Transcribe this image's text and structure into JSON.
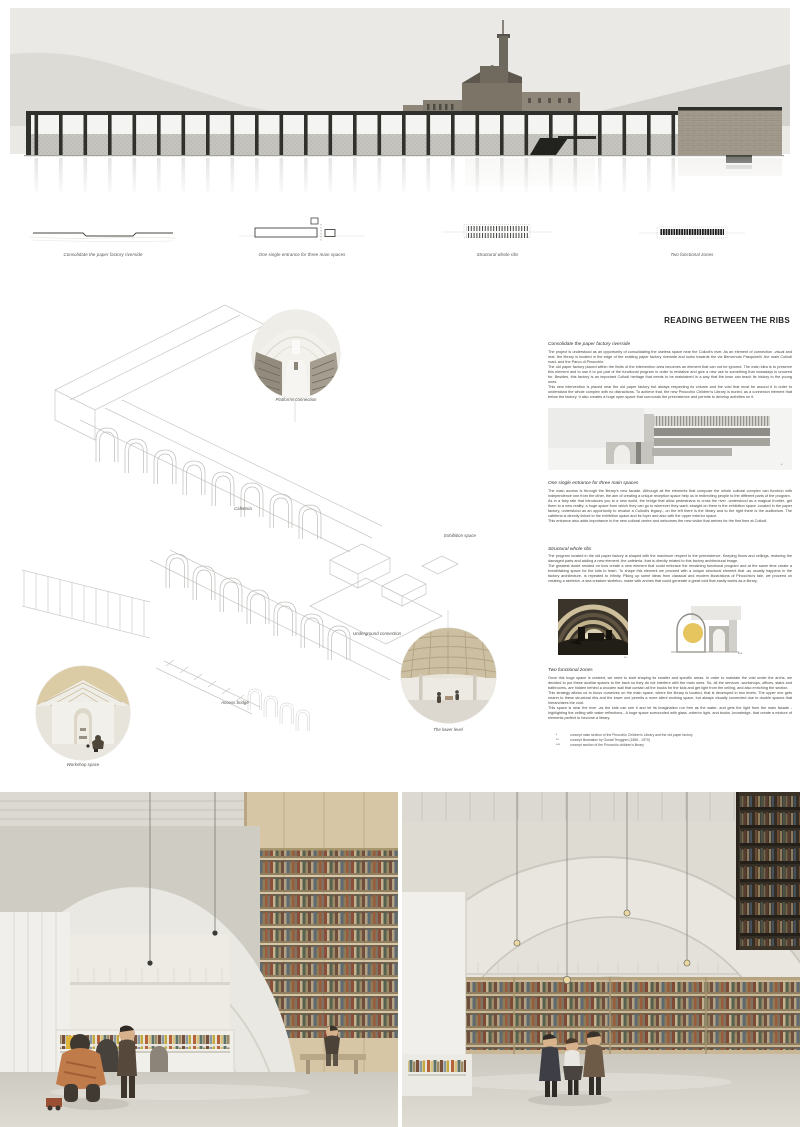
{
  "colors": {
    "board_bg": "#ffffff",
    "drawing_gray": "#e9e8e5",
    "ink": "#2f2f2b",
    "sepia": "#8a7f6c",
    "wood": "#d3c09d",
    "accent_yellow": "#e6c55e"
  },
  "concept_diagrams": [
    {
      "caption": "Consolidate the paper factory riverside"
    },
    {
      "caption": "One single entrance for three main spaces"
    },
    {
      "caption": "Structural whole ribs"
    },
    {
      "caption": "Two functional zones"
    }
  ],
  "axon_labels": {
    "platforms": "Platforms connection",
    "cafeteria": "Cafeteria",
    "exhibition": "Exhibition space",
    "underground": "Underground connection",
    "bridge": "Access bridge",
    "lower_level": "The lower level",
    "workshop": "Workshop space"
  },
  "article": {
    "title": "READING BETWEEN THE RIBS",
    "sections": [
      {
        "heading": "Consolidate the paper factory riverside",
        "body": "The project is understood as an opportunity of consolidating the useless space near the Collodi's river. As an element of connection -visual and real- the library is located in the edge of the existing paper factory riverside and looks towards the via Benvenuto Pasquinelli -the main Collodi road- and the Parco di Pinocchio.\nThe old paper factory placed within the limits of the intervention area becomes an element that can not be ignored. The main idea is to preserve this element and to use it to put part of the functional program in order to revitalize and give a new use to something that nowadays is uncared for. Besides, this factory is an important Collodi heritage that needs to be maintained in a way that the town can teach its history to the young ones.\nThis new intervention is placed near the old paper factory but always respecting its volume and the void that must be around it in order to understand the whole complex with no distractions. To achieve that, the new Pinocchio Children's Library is buried, as a connexion element that below the factory. It also creates a huge open space that surrounds the preexistence and permits to develop activities on it."
      },
      {
        "heading": "One single entrance for three main spaces",
        "body": "The main access is through the library's new facade. Although all the elements that compose the whole cultural complex can function with independence one from the other, the aim of creating a unique reception space help us in redirecting people to the different parts of the program.\nAs in a fairy tale that introduces you to a new world, the bridge that allow pedestrians to cross the river -understood as a magical frontier- get them to a new reality: a huge space from which they can go to wherever they want: straight on there is the exhibition space -located in the paper factory, understood as an opportunity to revalue a Collodi's legacy-, on the left there is the library and to the right there is the auditorium. The cafeteria is directly linked to the exhibition space and its foyer and also with the upper exterior space.\nThis entrance also adds importance to the new cultural centre and welcomes the new visitor that arrives for the first time at Collodi."
      },
      {
        "heading": "Structural whole ribs",
        "body": "The program located in the old paper factory is shaped with the maximum respect to the preexistence. Keeping floors and ceilings, restoring the damaged parts and adding a new element -the cafeteria- that is directly related to this factory architectural image.\nThe greatest doubt resided on how create a new element that could embrace the remaining functional program and at the same time create a breathtaking space for the kids to learn. To shape this element we proceed with a unique structural element that -as usually happens in the factory architecture- is repeated to infinity. Piking up some ideas from classical and modern illustrations of Pinocchio's tale, we proceed on creating a skeleton -a sea creature skeleton- made with arches that could generate a great void that easily works as a library."
      },
      {
        "heading": "Two functional zones",
        "body": "Once this huge space is created, we need to start shaping its smaller and specific areas. In order to maintain the void under the archs, we decided to put these auxiliar spaces to the back so they do not interfere with the main ones. So, all the services -workshops, offices, stairs and bathrooms- are hidden behind a wooden wall that contain all the books for the kids and get light from the ceiling, and also enriching the section.\nThis strategy allows us to focus ourselves on the main space, where the library is located, that is developed in two levels. The upper one gets nearer to these structural ribs and the lower one permits a more silent working space, but always visually connected due to double spaces that hierarchizes the void.\nThis space is near the river -as the kids can see it and let its imagination run free as the water- and gets the light from the main facade -highlighting the ceiling with water reflections-. A huge space surrounded with glass -exterior light- and books -knowledge- that create a mixture of elements perfect to become a library."
      }
    ],
    "figure_marks": {
      "section": "*",
      "whale": "**",
      "sketch": "***"
    },
    "footnotes": [
      {
        "mark": "*",
        "text": "concept main section of the Pinocchio Children's Library and the old paper factory"
      },
      {
        "mark": "**",
        "text": "concept illustration by Gustaf Tenggren (1896 - 1970)"
      },
      {
        "mark": "***",
        "text": "concept section of the Pinocchio children's library"
      }
    ]
  }
}
